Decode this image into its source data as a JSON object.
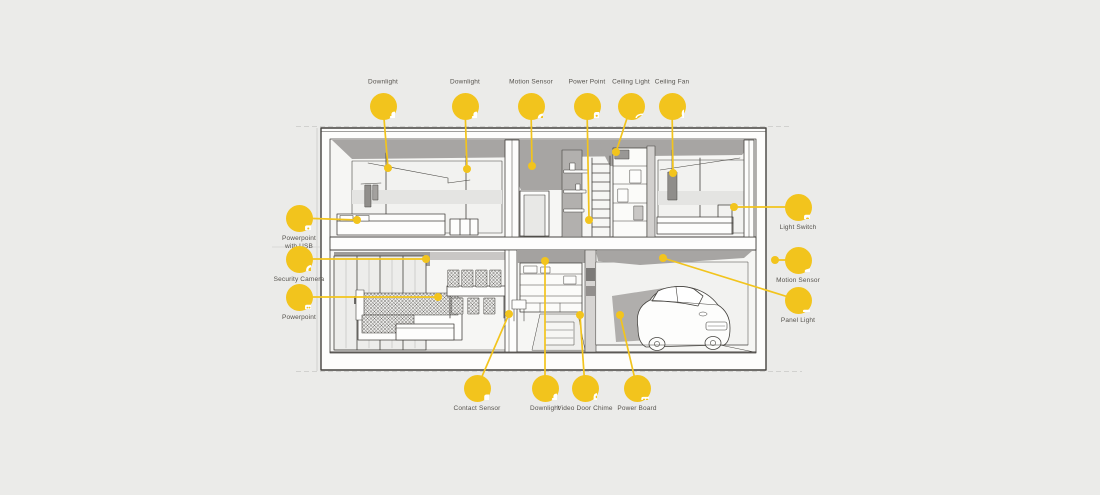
{
  "canvas": {
    "width": 1100,
    "height": 495,
    "background": "#ebebe9"
  },
  "palette": {
    "accent_yellow": "#f2c41d",
    "line_ink": "#45433f",
    "label_text": "#56534e",
    "ceiling_gray": "#a7a5a3",
    "wall_gray": "#d6d4d2",
    "glass_gray": "#f2f2f0"
  },
  "diagram": {
    "type": "smart-home-house-cutaway",
    "callouts": [
      {
        "id": "downlight-1",
        "label": "Downlight",
        "icon": "downlight-icon",
        "cx": 383,
        "cy": 106,
        "side": "top",
        "tx": 388,
        "ty": 168
      },
      {
        "id": "downlight-2",
        "label": "Downlight",
        "icon": "downlight-icon",
        "cx": 465,
        "cy": 106,
        "side": "top",
        "tx": 467,
        "ty": 169
      },
      {
        "id": "motion-sensor-1",
        "label": "Motion Sensor",
        "icon": "motion-sensor-icon",
        "cx": 531,
        "cy": 106,
        "side": "top",
        "tx": 532,
        "ty": 166
      },
      {
        "id": "power-point",
        "label": "Power Point",
        "icon": "power-point-icon",
        "cx": 587,
        "cy": 106,
        "side": "top",
        "tx": 589,
        "ty": 220
      },
      {
        "id": "ceiling-light",
        "label": "Ceiling Light",
        "icon": "ceiling-light-icon",
        "cx": 631,
        "cy": 106,
        "side": "top",
        "tx": 616,
        "ty": 152
      },
      {
        "id": "ceiling-fan",
        "label": "Ceiling Fan",
        "icon": "ceiling-fan-icon",
        "cx": 672,
        "cy": 106,
        "side": "top",
        "tx": 673,
        "ty": 173
      },
      {
        "id": "powerpoint-with-usb",
        "label": "Powerpoint with USB",
        "icon": "powerpoint-usb-icon",
        "cx": 299,
        "cy": 218,
        "side": "bottom",
        "tx": 357,
        "ty": 220,
        "wrap": true
      },
      {
        "id": "security-camera",
        "label": "Security Camera",
        "icon": "security-camera-icon",
        "cx": 299,
        "cy": 259,
        "side": "bottom",
        "tx": 426,
        "ty": 259
      },
      {
        "id": "powerpoint",
        "label": "Powerpoint",
        "icon": "powerpoint-icon",
        "cx": 299,
        "cy": 297,
        "side": "bottom",
        "tx": 438,
        "ty": 297
      },
      {
        "id": "light-switch",
        "label": "Light Switch",
        "icon": "light-switch-icon",
        "cx": 798,
        "cy": 207,
        "side": "bottom",
        "tx": 734,
        "ty": 207
      },
      {
        "id": "motion-sensor-2",
        "label": "Motion Sensor",
        "icon": "motion-sensor-2-icon",
        "cx": 798,
        "cy": 260,
        "side": "bottom",
        "tx": 775,
        "ty": 260
      },
      {
        "id": "panel-light",
        "label": "Panel Light",
        "icon": "panel-light-icon",
        "cx": 798,
        "cy": 300,
        "side": "bottom",
        "tx": 663,
        "ty": 258
      },
      {
        "id": "contact-sensor",
        "label": "Contact Sensor",
        "icon": "contact-sensor-icon",
        "cx": 477,
        "cy": 388,
        "side": "bottom",
        "tx": 509,
        "ty": 314
      },
      {
        "id": "downlight-3",
        "label": "Downlight",
        "icon": "downlight-icon",
        "cx": 545,
        "cy": 388,
        "side": "bottom",
        "tx": 545,
        "ty": 261
      },
      {
        "id": "video-door-chime",
        "label": "Video Door Chime",
        "icon": "video-door-chime-icon",
        "cx": 585,
        "cy": 388,
        "side": "bottom",
        "tx": 580,
        "ty": 315
      },
      {
        "id": "power-board",
        "label": "Power Board",
        "icon": "power-board-icon",
        "cx": 637,
        "cy": 388,
        "side": "bottom",
        "tx": 620,
        "ty": 315
      }
    ]
  }
}
